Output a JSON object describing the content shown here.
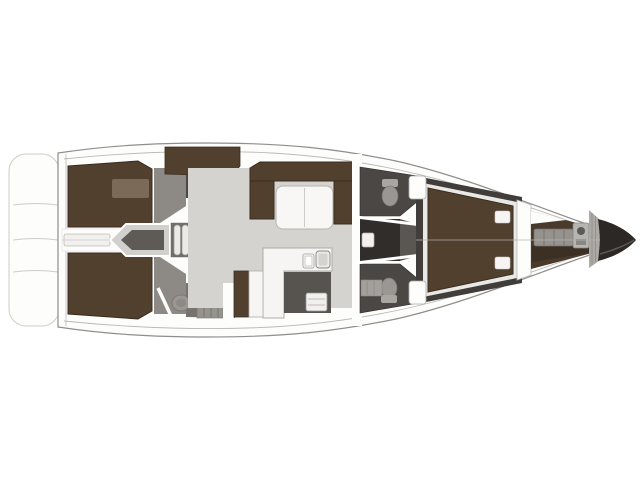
{
  "diagram": {
    "type": "sailing-yacht-interior-floor-plan",
    "view": "top-down deck layout, bow pointing right"
  },
  "colors": {
    "page_bg": "#ffffff",
    "hull_fill": "#fdfdfc",
    "hull_stroke": "#908e8a",
    "platform_line": "#cfcdc9",
    "deck_line": "#bcbab6",
    "floor_light": "#d5d3d0",
    "floor_mid": "#8d8a86",
    "floor_mid2": "#77746f",
    "floor_dark": "#4a4744",
    "worktop_dark": "#57544f",
    "corridor_dark": "#302d2a",
    "vestibule": "#5a5752",
    "wood": "#52402f",
    "wood_dark": "#392c1f",
    "wood_light": "#7b6a58",
    "white_furniture": "#f6f5f3",
    "furniture_stroke": "#aeaca8",
    "table_fill": "#f8f7f5",
    "table_stroke": "#b5b3af",
    "appliance": "#f1f0ee",
    "stove_fill": "#eceae8",
    "stove_inner": "#d5d3cf",
    "engine_outer": "#d2d0cd",
    "engine_inner": "#5e5b57",
    "step_bg": "#716e6a",
    "step_fill": "#eceae8",
    "toilet": "#9a9793",
    "toilet_rim": "#77746f",
    "tank": "#a9a6a2",
    "mat": "#a3a09c",
    "slat_shelf": "#96938f",
    "windlass": "#b7b5b1",
    "hatch": "#adaaa6",
    "hatch_line": "#8a8783",
    "berth_ring": "#403d3a",
    "berth_frame": "#e9e8e5",
    "pillow": "#f6f5f3",
    "forepeak": "#4a3a2c",
    "forepeak_dark": "#3c3025",
    "bow_cone": "#2b2825",
    "bow_cone_edge": "#6b635a",
    "door_panel": "#f2f1ef"
  },
  "regions": [
    {
      "name": "swim-platform",
      "color": "hull_fill"
    },
    {
      "name": "aft-cabin-port-berth",
      "color": "wood"
    },
    {
      "name": "aft-cabin-starboard-berth",
      "color": "wood"
    },
    {
      "name": "aft-head-port",
      "color": "floor_dark"
    },
    {
      "name": "aft-head-starboard",
      "color": "floor_mid2"
    },
    {
      "name": "engine-compartment",
      "color": "engine_inner"
    },
    {
      "name": "companionway-steps",
      "color": "step_fill"
    },
    {
      "name": "salon-settee",
      "color": "wood"
    },
    {
      "name": "salon-table",
      "color": "table_fill"
    },
    {
      "name": "galley-counter",
      "color": "white_furniture"
    },
    {
      "name": "galley-sink",
      "color": "appliance"
    },
    {
      "name": "galley-stove",
      "color": "stove_fill"
    },
    {
      "name": "head-forward-port",
      "color": "floor_dark"
    },
    {
      "name": "head-forward-starboard",
      "color": "floor_dark"
    },
    {
      "name": "corridor",
      "color": "corridor_dark"
    },
    {
      "name": "owner-cabin-island-berth",
      "color": "wood"
    },
    {
      "name": "forepeak-locker",
      "color": "forepeak"
    },
    {
      "name": "windlass",
      "color": "windlass"
    },
    {
      "name": "anchor-locker-hatch",
      "color": "hatch"
    },
    {
      "name": "bow-cone",
      "color": "bow_cone"
    }
  ]
}
